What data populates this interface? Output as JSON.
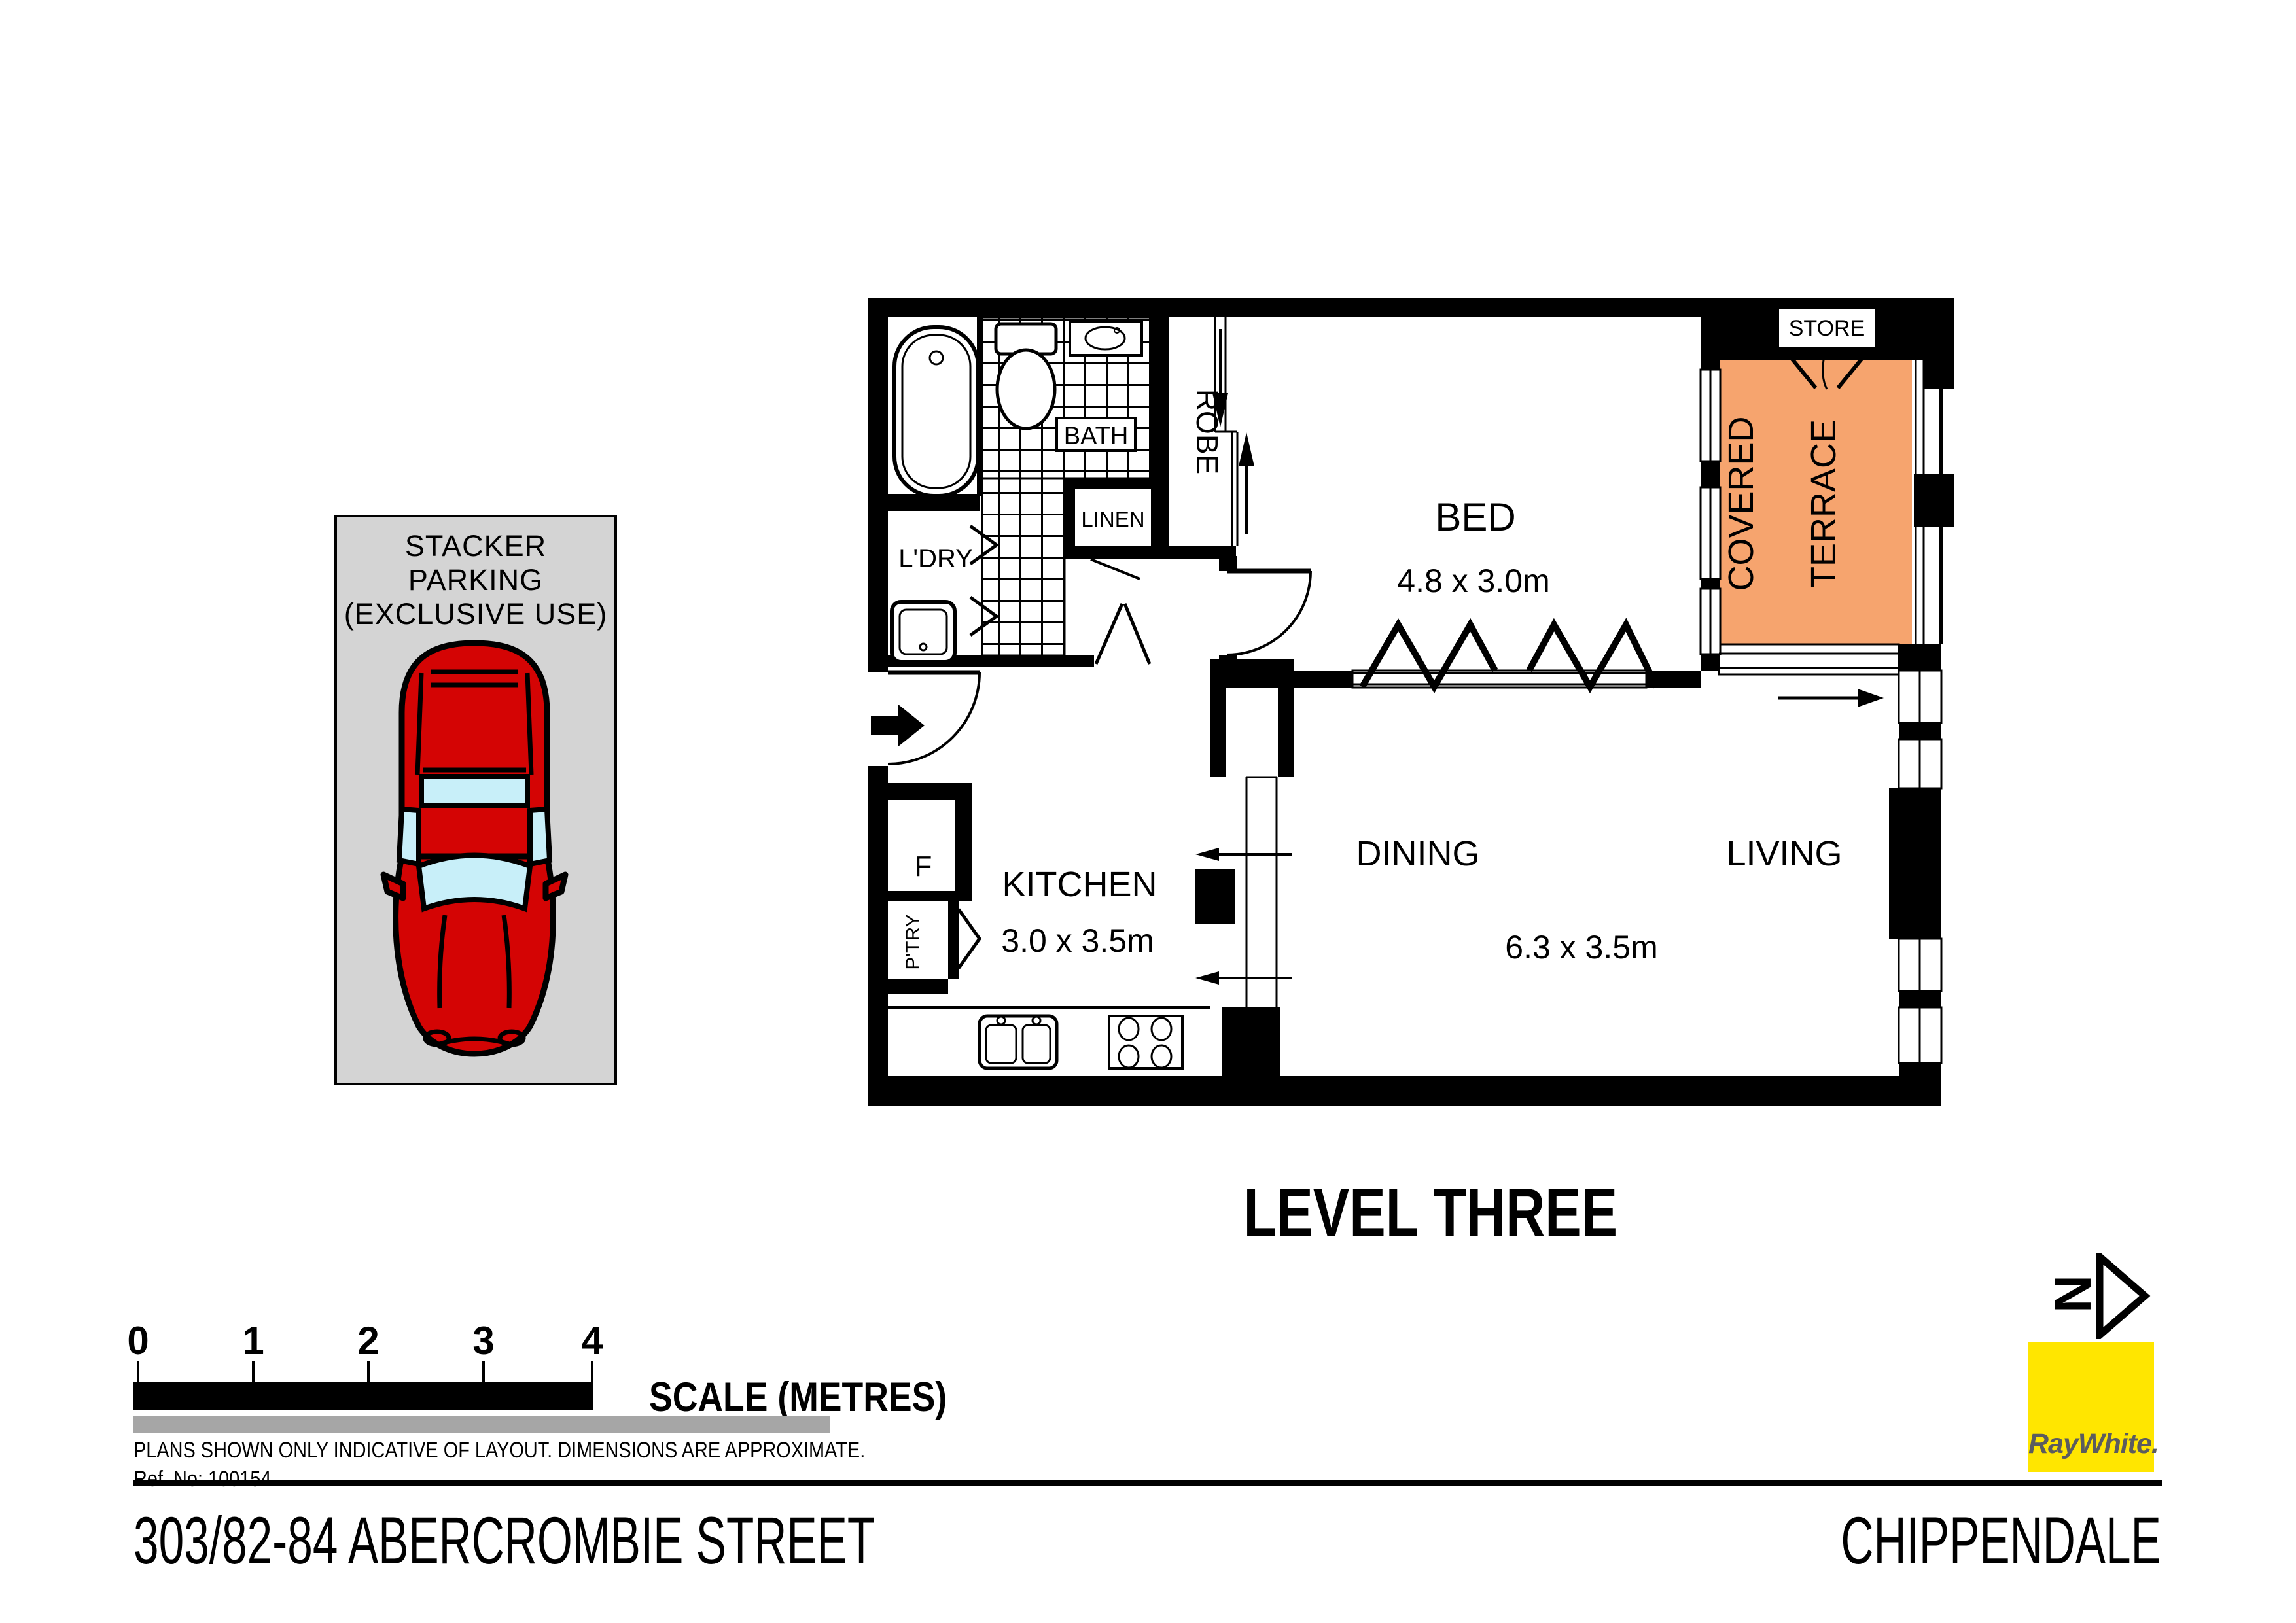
{
  "title": "LEVEL THREE",
  "address": "303/82-84 ABERCROMBIE STREET",
  "suburb": "CHIPPENDALE",
  "brand": {
    "name": "RayWhite.",
    "yellow": "#FFE600",
    "text_gray": "#5B5C5F"
  },
  "north_label": "N",
  "parking": {
    "line1": "STACKER",
    "line2": "PARKING",
    "line3": "(EXCLUSIVE USE)"
  },
  "plan": {
    "rooms": {
      "bath": "BATH",
      "robe": "ROBE",
      "linen": "LINEN",
      "laundry": "L'DRY",
      "store": "STORE",
      "terrace_line1": "COVERED",
      "terrace_line2": "TERRACE",
      "bed_label": "BED",
      "bed_dims": "4.8 x 3.0m",
      "kitchen_label": "KITCHEN",
      "kitchen_dims": "3.0 x 3.5m",
      "dining": "DINING",
      "living": "LIVING",
      "living_dining_dims": "6.3 x 3.5m",
      "fridge": "F",
      "pantry": "P'TRY"
    },
    "colors": {
      "terrace_fill": "#F6A46E",
      "walls": "#000000",
      "car_red": "#D40404",
      "car_glass": "#C8EFF9"
    }
  },
  "scale_bar": {
    "ticks": [
      "0",
      "1",
      "2",
      "3",
      "4"
    ],
    "label": "SCALE (METRES)"
  },
  "disclaimer": "PLANS SHOWN ONLY INDICATIVE OF LAYOUT.  DIMENSIONS ARE APPROXIMATE.",
  "ref": "Ref. No: 100154"
}
